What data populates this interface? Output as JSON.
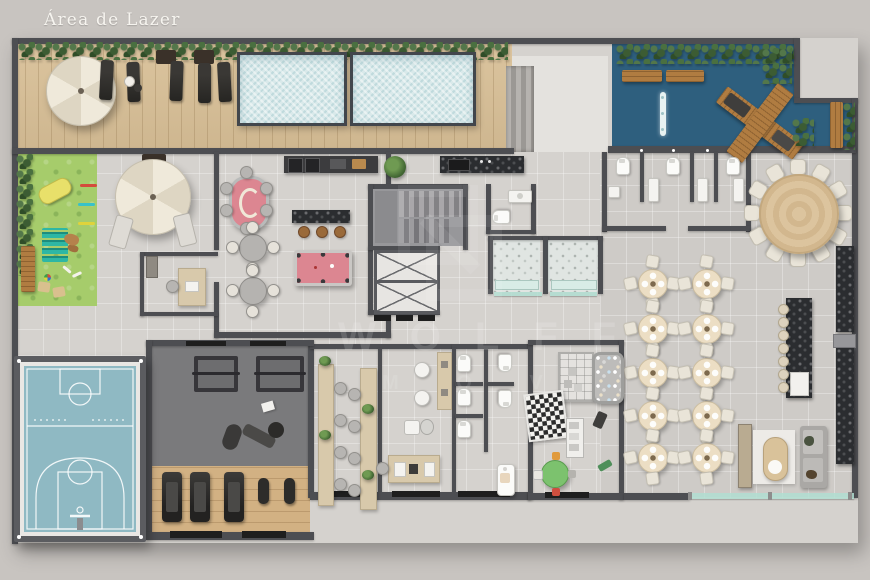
{
  "header": {
    "title": "Área de Lazer"
  },
  "watermark": {
    "brand": "WOLFF",
    "tagline": "M O V"
  },
  "colors": {
    "background": "#c8c4c0",
    "wall": "#4d4e52",
    "deck_wood": "#d9c097",
    "pool_water": "#d9e9ea",
    "terrace_blue": "#2e5f7e",
    "lawn_green": "#a6cc6b",
    "court_blue": "#8fb9c3",
    "court_rim": "#e9e7e4",
    "gym_floor": "#7a7a7c",
    "gym_wood": "#d2b183",
    "interior_floor": "#d5d2ce",
    "hall_floor": "#cecbc7",
    "accent_pink": "#dc8691",
    "marble_dark": "#2b2d30",
    "table_wood": "#dcc49e",
    "glass_teal": "#b0ded1",
    "umbrella_cream": "#e9e3d3"
  },
  "amenities": [
    "pool deck with parasol and sun loungers (5)",
    "swimming pools (2)",
    "blue water terrace with wooden pier and benches",
    "pet place lawn with agility toys",
    "lounge patio with parasol",
    "games room: poker table, snooker table, bar with 3 stools, two 4-seat tables",
    "gourmet counters and barbecue",
    "staircase and 2 elevators",
    "saunas (2) and changing showers",
    "restrooms (3 blocks)",
    "party hall: 10 round tables x4 seats, banquet round table x12 seats, bar with 7 stools",
    "lounge with sofa and oval coffee table",
    "sports court (basketball)",
    "gym: 2 racks, bench station, 3 treadmills, 2 bikes",
    "coworking with 2 long desks",
    "beauty salon",
    "kids playroom: ball pit, foam blocks, giant chess mat, kids table"
  ]
}
